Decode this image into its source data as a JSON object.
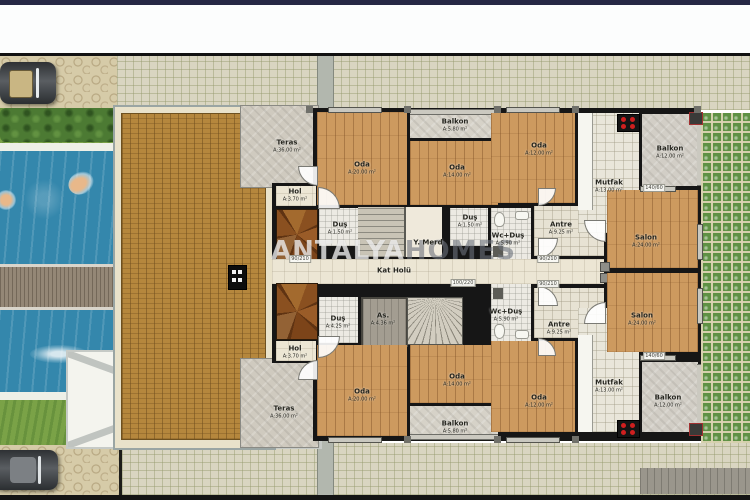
{
  "watermark": {
    "primary": "ANTALYA",
    "secondary": "HOMES"
  },
  "rooms": [
    {
      "id": "teras-top",
      "label": "Teras",
      "area": "A:36.00 m²",
      "x": 287,
      "y": 146
    },
    {
      "id": "oda20-top",
      "label": "Oda",
      "area": "A:20.00 m²",
      "x": 362,
      "y": 168
    },
    {
      "id": "balkon58-top",
      "label": "Balkon",
      "area": "A:5.80 m²",
      "x": 455,
      "y": 125
    },
    {
      "id": "oda14-top",
      "label": "Oda",
      "area": "A:14.00 m²",
      "x": 457,
      "y": 171
    },
    {
      "id": "oda12-top",
      "label": "Oda",
      "area": "A:12.00 m²",
      "x": 539,
      "y": 149
    },
    {
      "id": "mutfak-top",
      "label": "Mutfak",
      "area": "A:13.00 m²",
      "x": 609,
      "y": 186
    },
    {
      "id": "balkon12-top",
      "label": "Balkon",
      "area": "A:12.00 m²",
      "x": 670,
      "y": 152
    },
    {
      "id": "hol-top",
      "label": "Hol",
      "area": "A:3.70 m²",
      "x": 295,
      "y": 195
    },
    {
      "id": "dus-left-top",
      "label": "Duş",
      "area": "A:1.50 m²",
      "x": 340,
      "y": 228
    },
    {
      "id": "y-merd",
      "label": "Y. Merd",
      "area": "",
      "x": 428,
      "y": 243
    },
    {
      "id": "dus-right-top",
      "label": "Duş",
      "area": "A:1.50 m²",
      "x": 470,
      "y": 221
    },
    {
      "id": "wcdus-top",
      "label": "Wc+Duş",
      "area": "A:5.90 m²",
      "x": 508,
      "y": 239
    },
    {
      "id": "antre-top",
      "label": "Antre",
      "area": "A:9.25 m²",
      "x": 561,
      "y": 228
    },
    {
      "id": "salon-top",
      "label": "Salon",
      "area": "A:24.00 m²",
      "x": 646,
      "y": 241
    },
    {
      "id": "kat-holu",
      "label": "Kat Holü",
      "area": "",
      "x": 394,
      "y": 271
    },
    {
      "id": "dus-425",
      "label": "Duş",
      "area": "A:4.25 m²",
      "x": 338,
      "y": 322
    },
    {
      "id": "asansor",
      "label": "As.",
      "area": "A:4.36 m²",
      "x": 383,
      "y": 319
    },
    {
      "id": "wcdus-bottom",
      "label": "Wc+Duş",
      "area": "A:5.90 m²",
      "x": 506,
      "y": 315
    },
    {
      "id": "antre-bottom",
      "label": "Antre",
      "area": "A:9.25 m²",
      "x": 559,
      "y": 328
    },
    {
      "id": "salon-bottom",
      "label": "Salon",
      "area": "A:24.00 m²",
      "x": 642,
      "y": 319
    },
    {
      "id": "hol-bottom",
      "label": "Hol",
      "area": "A:3.70 m²",
      "x": 295,
      "y": 352
    },
    {
      "id": "oda20-bottom",
      "label": "Oda",
      "area": "A:20.00 m²",
      "x": 362,
      "y": 395
    },
    {
      "id": "oda14-bottom",
      "label": "Oda",
      "area": "A:14.00 m²",
      "x": 457,
      "y": 380
    },
    {
      "id": "balkon58-bottom",
      "label": "Balkon",
      "area": "A:5.80 m²",
      "x": 455,
      "y": 427
    },
    {
      "id": "oda12-bottom",
      "label": "Oda",
      "area": "A:12.00 m²",
      "x": 539,
      "y": 401
    },
    {
      "id": "mutfak-bottom",
      "label": "Mutfak",
      "area": "A:13.00 m²",
      "x": 609,
      "y": 386
    },
    {
      "id": "balkon12-bottom",
      "label": "Balkon",
      "area": "A:12.00 m²",
      "x": 668,
      "y": 401
    },
    {
      "id": "teras-bottom",
      "label": "Teras",
      "area": "A:36.00 m²",
      "x": 284,
      "y": 412
    }
  ],
  "dim_labels": [
    {
      "text": "90/210",
      "x": 300,
      "y": 259
    },
    {
      "text": "100/220",
      "x": 463,
      "y": 283
    },
    {
      "text": "90/210",
      "x": 548,
      "y": 259
    },
    {
      "text": "90/210",
      "x": 548,
      "y": 284
    },
    {
      "text": "140/60",
      "x": 654,
      "y": 188
    },
    {
      "text": "140/60",
      "x": 654,
      "y": 356
    }
  ],
  "colors": {
    "top_bar": "#262845",
    "terrace_brick": "#b5873d",
    "wood_floor": "#cd9a5f",
    "pool_water": "#3487ac",
    "green_paver": "#5e9144",
    "grass": "#7aa247",
    "stove_burner": "#cf1f1f"
  }
}
